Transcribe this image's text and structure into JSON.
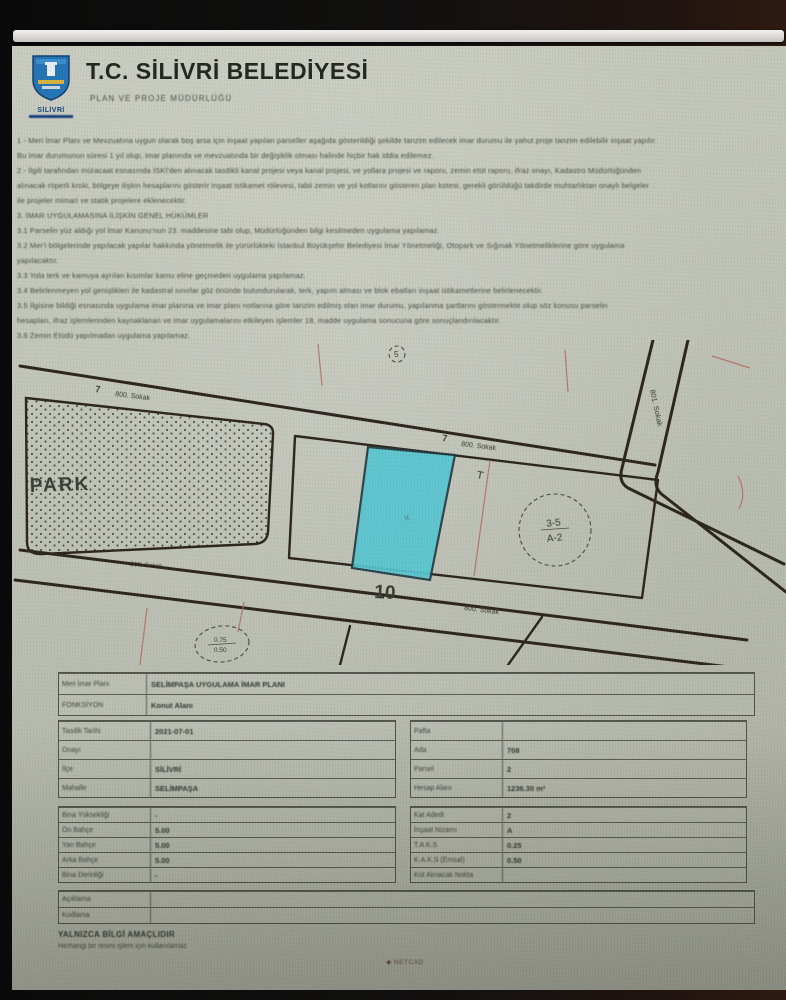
{
  "header": {
    "title": "T.C. SİLİVRİ BELEDİYESİ",
    "subtitle": "PLAN VE PROJE MÜDÜRLÜĞÜ",
    "logo_caption": "SİLİVRİ"
  },
  "notes": {
    "lines": [
      "1 - Meri İmar Planı ve Mevzuatına uygun olarak boş arsa için inşaat yapılan parseller aşağıda gösterildiği şekilde tanzim edilecek imar durumu ile yahut proje tanzim edilebilir inşaat yapılır.",
      "Bu imar durumunun süresi 1 yıl olup, imar planında ve mevzuatında bir değişiklik olması halinde hiçbir hak iddia edilemez.",
      "2 - İlgili tarafından müracaat esnasında İSKİ'den alınacak tasdikli kanal projesi veya kanal projesi, ve yollara projesi ve raporu, zemin etüt raporu, ifraz onayı, Kadastro Müdürlüğünden",
      "alınacak röperli kroki, bölgeye ilişkin hesaplarını gösterir inşaat istikamet rölevesi, tabii zemin ve yol kotlarını gösteren plan kotesi, gerekli görüldüğü takdirde muhtarlıktan onaylı belgeler",
      "ile projeler mimari ve statik projelere eklenecektir.",
      "3. İMAR UYGULAMASINA İLİŞKİN GENEL HÜKÜMLER",
      "3.1 Parselin yüz aldığı yol İmar Kanunu'nun 23. maddesine tabi olup, Müdürlüğünden bilgi kesilmeden uygulama yapılamaz.",
      "3.2 Mer'i bölgelerinde yapılacak yapılar hakkında yönetmelik ile yürürlükteki İstanbul Büyükşehir Belediyesi İmar Yönetmeliği, Otopark ve Sığınak Yönetmeliklerine göre uygulama",
      "yapılacaktır.",
      "3.3 Yola terk ve kamuya ayrılan kısımlar kamu eline geçmeden uygulama yapılamaz.",
      "3.4 Belirlenmeyen yol genişlikleri ile kadastral sınırlar göz önünde bulundurularak, terk, yapım alması ve blok ebatları inşaat istikametlerine belirlenecektir.",
      "3.5 İlgisine bildiği esnasında uygulama imar planına ve imar planı notlarına göre tanzim edilmiş olan imar durumu, yapılanma şartlarını göstermekte olup söz konusu parselin",
      "hesapları, ifraz işlemlerinden kaynaklanan ve imar uygulamalarını etkileyen işlemler 18. madde uygulama sonucuna göre sonuçlandırılacaktır.",
      "3.6 Zemin Etüdü yapılmadan uygulama yapılamaz."
    ]
  },
  "map": {
    "park_label": "PARK",
    "block_number_10": "10",
    "block_number_7_left": "7",
    "block_number_7_right": "7",
    "street_top": "800. Sokak",
    "street_middle": "800. Sokak",
    "street_under_park": "800. Sokak",
    "street_bottom": "800. Sokak",
    "street_right": "801. Sokak",
    "zoning_note_top": "3-5",
    "zoning_note_bottom": "A-2",
    "corner_note": "5",
    "ratio_top": "0.75",
    "ratio_bottom": "0.50",
    "t_mark": "T",
    "highlight_color": "#56c6d1"
  },
  "tables": {
    "a": [
      {
        "label": "Meri İmar Planı",
        "value": "SELİMPAŞA UYGULAMA İMAR PLANI"
      },
      {
        "label": "FONKSİYON",
        "value": "Konut Alanı"
      }
    ],
    "b": [
      {
        "label": "Tasdik Tarihi",
        "value": "2021-07-01"
      },
      {
        "label": "Onayı",
        "value": ""
      },
      {
        "label": "İlçe",
        "value": "SİLİVRİ"
      },
      {
        "label": "Mahalle",
        "value": "SELİMPAŞA"
      }
    ],
    "c": [
      {
        "label": "Pafta",
        "value": ""
      },
      {
        "label": "Ada",
        "value": "708"
      },
      {
        "label": "Parsel",
        "value": "2"
      },
      {
        "label": "Hesap Alanı",
        "value": "1236.30 m²"
      }
    ],
    "d": [
      {
        "label": "Bina Yüksekliği",
        "value": "-"
      },
      {
        "label": "Ön Bahçe",
        "value": "5.00"
      },
      {
        "label": "Yan Bahçe",
        "value": "5.00"
      },
      {
        "label": "Arka Bahçe",
        "value": "5.00"
      },
      {
        "label": "Bina Derinliği",
        "value": "-"
      }
    ],
    "e": [
      {
        "label": "Kat Adedi",
        "value": "2"
      },
      {
        "label": "İnşaat Nizamı",
        "value": "A"
      },
      {
        "label": "T.A.K.S",
        "value": "0.25"
      },
      {
        "label": "K.A.K.S (Emsal)",
        "value": "0.50"
      },
      {
        "label": "Kot Alınacak Nokta",
        "value": ""
      }
    ],
    "f": [
      {
        "label": "Açıklama",
        "value": ""
      },
      {
        "label": "Kodlama",
        "value": ""
      }
    ]
  },
  "footer": {
    "notice": "YALNIZCA BİLGİ AMAÇLIDIR",
    "notice_sub": "Herhangi bir resmi işlem için kullanılamaz",
    "watermark_icon": "◆",
    "watermark": "NETCAD"
  }
}
